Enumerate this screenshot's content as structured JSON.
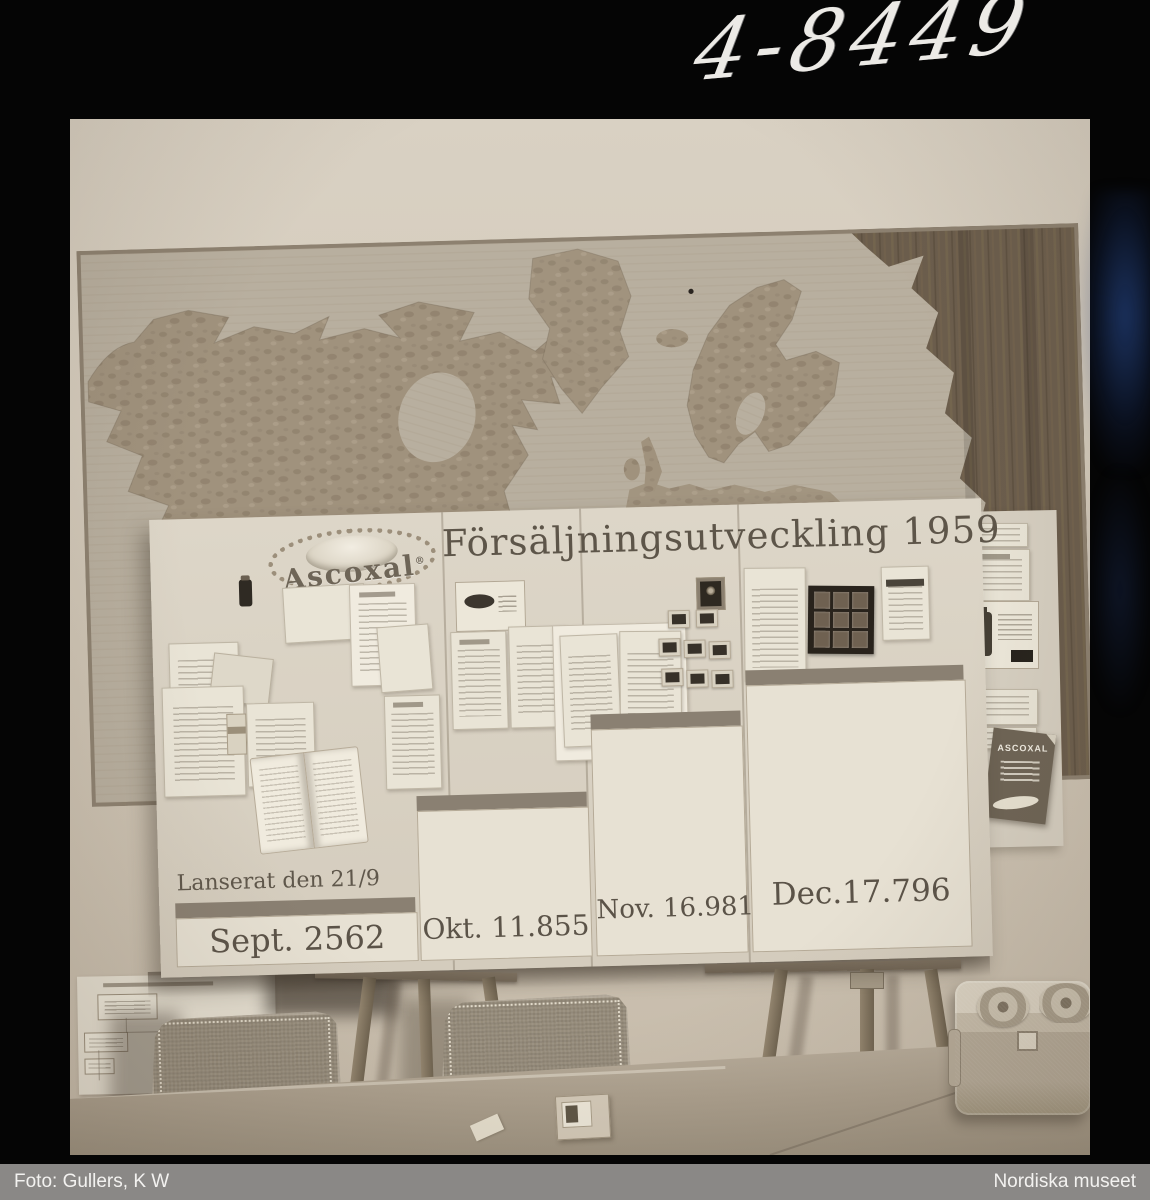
{
  "annotation": {
    "ref_number": "4-8449"
  },
  "footer": {
    "photographer": "Foto: Gullers, K W",
    "archive": "Nordiska museet"
  },
  "board": {
    "brand": "Ascoxal",
    "brand_trademark": "®",
    "title": "Försäljningsutveckling 1959",
    "launch_note": "Lanserat den 21/9",
    "columns": [
      {
        "label": "Sept.",
        "value": "2562"
      },
      {
        "label": "Okt.",
        "value": "11.855"
      },
      {
        "label": "Nov.",
        "value": "16.981"
      },
      {
        "label": "Dec.",
        "value": "17.796"
      }
    ]
  },
  "pamphlet": {
    "title": "ASCOXAL"
  },
  "chart_data": {
    "type": "bar",
    "categories": [
      "Sept",
      "Okt",
      "Nov",
      "Dec"
    ],
    "values": [
      2562,
      11855,
      16981,
      17796
    ],
    "title": "Försäljningsutveckling 1959",
    "annotations": [
      "Lanserat den 21/9"
    ],
    "note": "stepped display board, bars ascend left to right"
  },
  "colors": {
    "photo_sepia": "#cdc3b3",
    "board": "#d8d1c3",
    "dark_bar": "#8a8072",
    "ink": "#5b5348",
    "map_light_wood": "#b8af9f",
    "map_dark_wood": "#6b5d4c",
    "caption_bar": "#8a8886",
    "surround": "#050505"
  }
}
